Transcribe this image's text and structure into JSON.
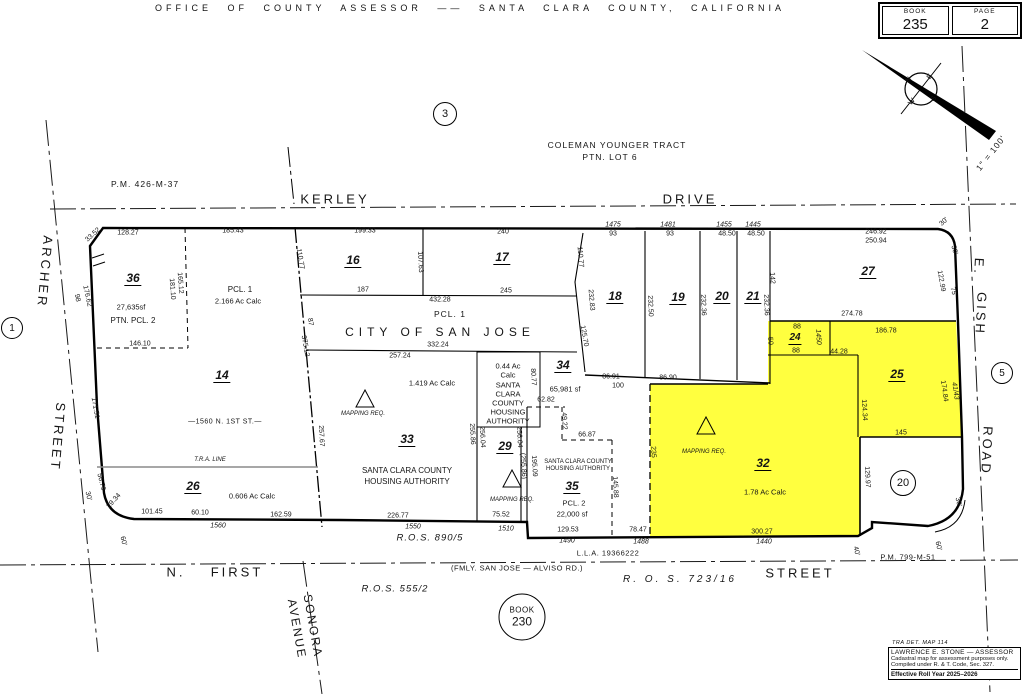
{
  "header": {
    "title": "OFFICE OF COUNTY ASSESSOR —— SANTA CLARA COUNTY, CALIFORNIA"
  },
  "book_box": {
    "book_label": "BOOK",
    "book_number": "235",
    "page_label": "PAGE",
    "page_number": "2"
  },
  "circled_refs": {
    "ref1": "1",
    "ref3": "3",
    "ref5": "5",
    "ref20": "20",
    "book230_line1": "BOOK",
    "book230_line2": "230"
  },
  "stamp": {
    "tra": "TRA DET. MAP 114",
    "line1": "LAWRENCE E. STONE — ASSESSOR",
    "line2": "Cadastral map for assessment purposes only.",
    "line3": "Compiled under R. & T. Code, Sec. 327.",
    "line4": "Effective Roll Year 2025–2026"
  },
  "colors": {
    "highlight": "#ffff3f",
    "line": "#000000",
    "tra_line": "#8a8a8a",
    "background": "#ffffff"
  },
  "map_labels": [
    {
      "t": "KERLEY",
      "x": 335,
      "y": 199,
      "c": "st",
      "n": "street-label-kerley"
    },
    {
      "t": "DRIVE",
      "x": 690,
      "y": 199,
      "c": "st",
      "n": "street-label-drive"
    },
    {
      "t": "ARCHER",
      "x": 45,
      "y": 272,
      "r": 95,
      "c": "st",
      "n": "street-label-archer"
    },
    {
      "t": "STREET",
      "x": 58,
      "y": 437,
      "r": 95,
      "c": "st",
      "n": "street-label-archer-street"
    },
    {
      "t": "E.",
      "x": 979,
      "y": 267,
      "r": 93,
      "c": "st",
      "n": "street-label-e-gish"
    },
    {
      "t": "GISH",
      "x": 981,
      "y": 314,
      "r": 93,
      "c": "st",
      "n": "street-label-gish"
    },
    {
      "t": "ROAD",
      "x": 987,
      "y": 451,
      "r": 93,
      "c": "st",
      "n": "street-label-gish-road"
    },
    {
      "t": "N.",
      "x": 176,
      "y": 572,
      "c": "st",
      "n": "street-label-n-first"
    },
    {
      "t": "FIRST",
      "x": 237,
      "y": 572,
      "c": "st",
      "n": "street-label-first"
    },
    {
      "t": "STREET",
      "x": 800,
      "y": 573,
      "c": "st",
      "n": "street-label-first-street"
    },
    {
      "t": "SONORA",
      "x": 313,
      "y": 626,
      "r": 80,
      "c": "st2",
      "n": "street-label-sonora"
    },
    {
      "t": "AVENUE",
      "x": 297,
      "y": 629,
      "r": 80,
      "c": "st2",
      "n": "street-label-avenue"
    },
    {
      "t": "COLEMAN YOUNGER TRACT",
      "x": 617,
      "y": 145,
      "c": "med",
      "n": "tract-label"
    },
    {
      "t": "PTN. LOT 6",
      "x": 610,
      "y": 157,
      "c": "med",
      "n": "tract-lot-label"
    },
    {
      "t": "P.M. 426-M-37",
      "x": 145,
      "y": 184,
      "c": "med",
      "n": "pm-426-label"
    },
    {
      "t": "PCL. 1",
      "x": 450,
      "y": 314,
      "c": "med",
      "n": "pcl-1-label"
    },
    {
      "t": "CITY OF SAN JOSE",
      "x": 440,
      "y": 332,
      "c": "city",
      "n": "city-of-san-jose-label"
    },
    {
      "t": "R.O.S. 890/5",
      "x": 430,
      "y": 538,
      "c": "medi",
      "n": "ros-890-label"
    },
    {
      "t": "R.O.S. 555/2",
      "x": 395,
      "y": 589,
      "c": "medi",
      "n": "ros-555-label"
    },
    {
      "t": "R. O. S.   723/16",
      "x": 680,
      "y": 580,
      "c": "medi2",
      "n": "ros-723-label"
    },
    {
      "t": "(FMLY. SAN JOSE — ALVISO RD.)",
      "x": 517,
      "y": 568,
      "c": "sm",
      "n": "fmly-alviso-label"
    },
    {
      "t": "L.L.A. 19366222",
      "x": 608,
      "y": 553,
      "c": "sm",
      "n": "lla-label"
    },
    {
      "t": "P.M. 799-M-51",
      "x": 908,
      "y": 557,
      "c": "sm",
      "n": "pm-799-label"
    },
    {
      "t": "T.R.A. LINE",
      "x": 210,
      "y": 460,
      "c": "tiny",
      "n": "tra-line-label"
    },
    {
      "t": "—1560 N. 1ST ST.—",
      "x": 225,
      "y": 422,
      "c": "sm2",
      "n": "n-1st-address-label"
    },
    {
      "t": "1\" = 100'",
      "x": 991,
      "y": 153,
      "r": -52,
      "c": "med",
      "n": "scale-label"
    },
    {
      "t": "N",
      "x": 909,
      "y": 80,
      "r": -50,
      "c": "cmp",
      "n": "compass-n"
    },
    {
      "t": "E",
      "x": 930,
      "y": 77,
      "r": -50,
      "c": "cmp",
      "n": "compass-e"
    },
    {
      "t": "W",
      "x": 912,
      "y": 102,
      "r": -50,
      "c": "cmp",
      "n": "compass-w"
    },
    {
      "t": "S",
      "x": 934,
      "y": 99,
      "r": -50,
      "c": "cmp",
      "n": "compass-s"
    },
    {
      "t": "36",
      "x": 133,
      "y": 279,
      "c": "pnum",
      "n": "parcel-36-number"
    },
    {
      "t": "14",
      "x": 222,
      "y": 376,
      "c": "pnum",
      "n": "parcel-14-number"
    },
    {
      "t": "16",
      "x": 353,
      "y": 261,
      "c": "pnum",
      "n": "parcel-16-number"
    },
    {
      "t": "17",
      "x": 502,
      "y": 258,
      "c": "pnum",
      "n": "parcel-17-number"
    },
    {
      "t": "18",
      "x": 615,
      "y": 297,
      "c": "pnum",
      "n": "parcel-18-number"
    },
    {
      "t": "19",
      "x": 678,
      "y": 298,
      "c": "pnum",
      "n": "parcel-19-number"
    },
    {
      "t": "20",
      "x": 722,
      "y": 297,
      "c": "pnum",
      "n": "parcel-20-number"
    },
    {
      "t": "21",
      "x": 753,
      "y": 297,
      "c": "pnum",
      "n": "parcel-21-number"
    },
    {
      "t": "27",
      "x": 868,
      "y": 272,
      "c": "pnum",
      "n": "parcel-27-number"
    },
    {
      "t": "24",
      "x": 795,
      "y": 339,
      "c": "pnum2",
      "n": "parcel-24-number"
    },
    {
      "t": "25",
      "x": 897,
      "y": 375,
      "c": "pnum",
      "n": "parcel-25-number"
    },
    {
      "t": "26",
      "x": 193,
      "y": 487,
      "c": "pnum",
      "n": "parcel-26-number"
    },
    {
      "t": "29",
      "x": 505,
      "y": 447,
      "c": "pnum",
      "n": "parcel-29-number"
    },
    {
      "t": "32",
      "x": 763,
      "y": 464,
      "c": "pnum",
      "n": "parcel-32-number"
    },
    {
      "t": "33",
      "x": 407,
      "y": 440,
      "c": "pnum",
      "n": "parcel-33-number"
    },
    {
      "t": "34",
      "x": 563,
      "y": 366,
      "c": "pnum",
      "n": "parcel-34-number"
    },
    {
      "t": "35",
      "x": 572,
      "y": 487,
      "c": "pnum",
      "n": "parcel-35-number"
    },
    {
      "t": "27,635sf",
      "x": 131,
      "y": 307,
      "c": "own",
      "n": "parcel-36-area"
    },
    {
      "t": "PTN. PCL. 2",
      "x": 133,
      "y": 321,
      "c": "own2",
      "n": "parcel-36-note"
    },
    {
      "t": "PCL. 1",
      "x": 240,
      "y": 290,
      "c": "own2",
      "n": "parcel-14-note"
    },
    {
      "t": "2.166 Ac Calc",
      "x": 238,
      "y": 301,
      "c": "own",
      "n": "parcel-14-area"
    },
    {
      "t": "1.419 Ac Calc",
      "x": 432,
      "y": 383,
      "c": "own",
      "n": "parcel-33-area"
    },
    {
      "t": "SANTA CLARA COUNTY",
      "x": 407,
      "y": 471,
      "c": "own2",
      "n": "parcel-33-owner"
    },
    {
      "t": "HOUSING AUTHORITY",
      "x": 407,
      "y": 482,
      "c": "own2",
      "n": "parcel-33-owner2"
    },
    {
      "t": "0.44 Ac",
      "x": 508,
      "y": 366,
      "c": "own"
    },
    {
      "t": "Calc",
      "x": 508,
      "y": 375,
      "c": "own",
      "n": "parcel-29-area"
    },
    {
      "t": "SANTA",
      "x": 508,
      "y": 385,
      "c": "own"
    },
    {
      "t": "CLARA",
      "x": 508,
      "y": 394,
      "c": "own"
    },
    {
      "t": "COUNTY",
      "x": 508,
      "y": 403,
      "c": "own"
    },
    {
      "t": "HOUSING",
      "x": 508,
      "y": 412,
      "c": "own"
    },
    {
      "t": "AUTHORITY",
      "x": 508,
      "y": 421,
      "c": "own",
      "n": "parcel-29-owner"
    },
    {
      "t": "65,981 sf",
      "x": 565,
      "y": 389,
      "c": "own",
      "n": "parcel-34-area"
    },
    {
      "t": "0.606 Ac Calc",
      "x": 252,
      "y": 496,
      "c": "own",
      "n": "parcel-26-area"
    },
    {
      "t": "1.78 Ac Calc",
      "x": 765,
      "y": 492,
      "c": "own",
      "n": "parcel-32-area"
    },
    {
      "t": "SANTA CLARA COUNTY",
      "x": 578,
      "y": 462,
      "c": "tiny2",
      "n": "parcel-35-owner"
    },
    {
      "t": "HOUSING AUTHORITY",
      "x": 578,
      "y": 469,
      "c": "tiny2",
      "n": "parcel-35-owner2"
    },
    {
      "t": "PCL. 2",
      "x": 574,
      "y": 503,
      "c": "own",
      "n": "parcel-35-note"
    },
    {
      "t": "22,000 sf",
      "x": 572,
      "y": 514,
      "c": "own",
      "n": "parcel-35-area"
    },
    {
      "t": "MAPPING REQ.",
      "x": 363,
      "y": 414,
      "c": "tiny",
      "n": "mapping-req-33"
    },
    {
      "t": "MAPPING REQ.",
      "x": 512,
      "y": 500,
      "c": "tiny",
      "n": "mapping-req-29"
    },
    {
      "t": "MAPPING REQ.",
      "x": 704,
      "y": 452,
      "c": "tiny",
      "n": "mapping-req-32"
    },
    {
      "t": "128.27",
      "x": 128,
      "y": 233
    },
    {
      "t": "33.52",
      "x": 93,
      "y": 235,
      "r": -42
    },
    {
      "t": "185.43",
      "x": 233,
      "y": 231
    },
    {
      "t": "199.33",
      "x": 365,
      "y": 231
    },
    {
      "t": "240",
      "x": 503,
      "y": 232
    },
    {
      "t": "1475",
      "x": 613,
      "y": 225,
      "c": "adr"
    },
    {
      "t": "93",
      "x": 613,
      "y": 234
    },
    {
      "t": "1481",
      "x": 668,
      "y": 225,
      "c": "adr"
    },
    {
      "t": "93",
      "x": 670,
      "y": 234
    },
    {
      "t": "1455",
      "x": 724,
      "y": 225,
      "c": "adr"
    },
    {
      "t": "48.50",
      "x": 727,
      "y": 234
    },
    {
      "t": "1445",
      "x": 753,
      "y": 225,
      "c": "adr"
    },
    {
      "t": "48.50",
      "x": 756,
      "y": 234
    },
    {
      "t": "246.92",
      "x": 876,
      "y": 232
    },
    {
      "t": "250.94",
      "x": 876,
      "y": 241
    },
    {
      "t": "30'",
      "x": 944,
      "y": 222,
      "r": -42
    },
    {
      "t": "107.63",
      "x": 420,
      "y": 262,
      "r": 87
    },
    {
      "t": "187",
      "x": 363,
      "y": 290
    },
    {
      "t": "432.28",
      "x": 440,
      "y": 300
    },
    {
      "t": "245",
      "x": 506,
      "y": 291
    },
    {
      "t": "110.77",
      "x": 300,
      "y": 259,
      "r": 80
    },
    {
      "t": "87",
      "x": 310,
      "y": 322,
      "r": 80
    },
    {
      "t": "375.12",
      "x": 305,
      "y": 346,
      "r": 80
    },
    {
      "t": "110.77",
      "x": 580,
      "y": 257,
      "r": 85
    },
    {
      "t": "232.83",
      "x": 591,
      "y": 300,
      "r": 85
    },
    {
      "t": "125.70",
      "x": 584,
      "y": 336,
      "r": 80
    },
    {
      "t": "232.50",
      "x": 650,
      "y": 306,
      "r": 88
    },
    {
      "t": "232.36",
      "x": 703,
      "y": 305,
      "r": 88
    },
    {
      "t": "232.36",
      "x": 766,
      "y": 305,
      "r": 88
    },
    {
      "t": "142",
      "x": 772,
      "y": 278,
      "r": 88
    },
    {
      "t": "122.99",
      "x": 941,
      "y": 281,
      "r": 80
    },
    {
      "t": "30'",
      "x": 954,
      "y": 250,
      "r": 75
    },
    {
      "t": "75",
      "x": 953,
      "y": 291,
      "r": 75
    },
    {
      "t": "165.12",
      "x": 180,
      "y": 283,
      "r": 86
    },
    {
      "t": "181.10",
      "x": 172,
      "y": 289,
      "r": 86
    },
    {
      "t": "146.10",
      "x": 140,
      "y": 344
    },
    {
      "t": "176.62",
      "x": 87,
      "y": 296,
      "r": 78
    },
    {
      "t": "98",
      "x": 77,
      "y": 298,
      "r": 78
    },
    {
      "t": "171.51",
      "x": 95,
      "y": 408,
      "r": 80
    },
    {
      "t": "56.79",
      "x": 101,
      "y": 482,
      "r": 76
    },
    {
      "t": "30'",
      "x": 88,
      "y": 496,
      "r": 76
    },
    {
      "t": "29.34",
      "x": 114,
      "y": 501,
      "r": -48
    },
    {
      "t": "101.45",
      "x": 152,
      "y": 512
    },
    {
      "t": "60.10",
      "x": 200,
      "y": 513
    },
    {
      "t": "162.59",
      "x": 281,
      "y": 515
    },
    {
      "t": "1560",
      "x": 218,
      "y": 526,
      "c": "adr"
    },
    {
      "t": "60'",
      "x": 123,
      "y": 541,
      "r": 76
    },
    {
      "t": "257.67",
      "x": 321,
      "y": 436,
      "r": 87
    },
    {
      "t": "332.24",
      "x": 438,
      "y": 345
    },
    {
      "t": "257.24",
      "x": 400,
      "y": 356
    },
    {
      "t": "80.77",
      "x": 533,
      "y": 377,
      "r": 87
    },
    {
      "t": "62.82",
      "x": 546,
      "y": 400
    },
    {
      "t": "49.22",
      "x": 564,
      "y": 421,
      "r": 87
    },
    {
      "t": "66.87",
      "x": 587,
      "y": 435
    },
    {
      "t": "86.91",
      "x": 611,
      "y": 377
    },
    {
      "t": "100",
      "x": 618,
      "y": 386
    },
    {
      "t": "86.90",
      "x": 668,
      "y": 378
    },
    {
      "t": "255.86",
      "x": 472,
      "y": 434,
      "r": 87
    },
    {
      "t": "256.04",
      "x": 482,
      "y": 437,
      "r": 87
    },
    {
      "t": "256.04",
      "x": 519,
      "y": 437,
      "r": 87
    },
    {
      "t": "(255.86)",
      "x": 523,
      "y": 466,
      "r": 87
    },
    {
      "t": "195.09",
      "x": 534,
      "y": 466,
      "r": 87
    },
    {
      "t": "145.88",
      "x": 615,
      "y": 487,
      "r": 87
    },
    {
      "t": "226.77",
      "x": 398,
      "y": 516
    },
    {
      "t": "1550",
      "x": 413,
      "y": 527,
      "c": "adr"
    },
    {
      "t": "75.52",
      "x": 501,
      "y": 515
    },
    {
      "t": "1510",
      "x": 506,
      "y": 529,
      "c": "adr"
    },
    {
      "t": "129.53",
      "x": 568,
      "y": 530
    },
    {
      "t": "1490",
      "x": 567,
      "y": 541,
      "c": "adr"
    },
    {
      "t": "78.47",
      "x": 638,
      "y": 530
    },
    {
      "t": "1488",
      "x": 641,
      "y": 542,
      "c": "adr"
    },
    {
      "t": "300.27",
      "x": 762,
      "y": 532
    },
    {
      "t": "1440",
      "x": 764,
      "y": 542,
      "c": "adr"
    },
    {
      "t": "274.78",
      "x": 852,
      "y": 314
    },
    {
      "t": "186.78",
      "x": 886,
      "y": 331
    },
    {
      "t": "88",
      "x": 797,
      "y": 327
    },
    {
      "t": "88",
      "x": 796,
      "y": 351
    },
    {
      "t": "50",
      "x": 770,
      "y": 341,
      "r": 87
    },
    {
      "t": "1450",
      "x": 818,
      "y": 337,
      "r": 87,
      "c": "adr"
    },
    {
      "t": "44.28",
      "x": 839,
      "y": 352
    },
    {
      "t": "124.34",
      "x": 864,
      "y": 410,
      "r": 87
    },
    {
      "t": "174.84",
      "x": 944,
      "y": 391,
      "r": 82
    },
    {
      "t": "41/43",
      "x": 955,
      "y": 391,
      "r": 82,
      "c": "adr"
    },
    {
      "t": "145",
      "x": 901,
      "y": 433
    },
    {
      "t": "129.97",
      "x": 867,
      "y": 477,
      "r": 87
    },
    {
      "t": "235",
      "x": 653,
      "y": 452,
      "r": 87
    },
    {
      "t": "40'",
      "x": 856,
      "y": 551,
      "r": 76
    },
    {
      "t": "60'",
      "x": 938,
      "y": 546,
      "r": 76
    },
    {
      "t": "30'",
      "x": 958,
      "y": 502,
      "r": 76
    }
  ]
}
